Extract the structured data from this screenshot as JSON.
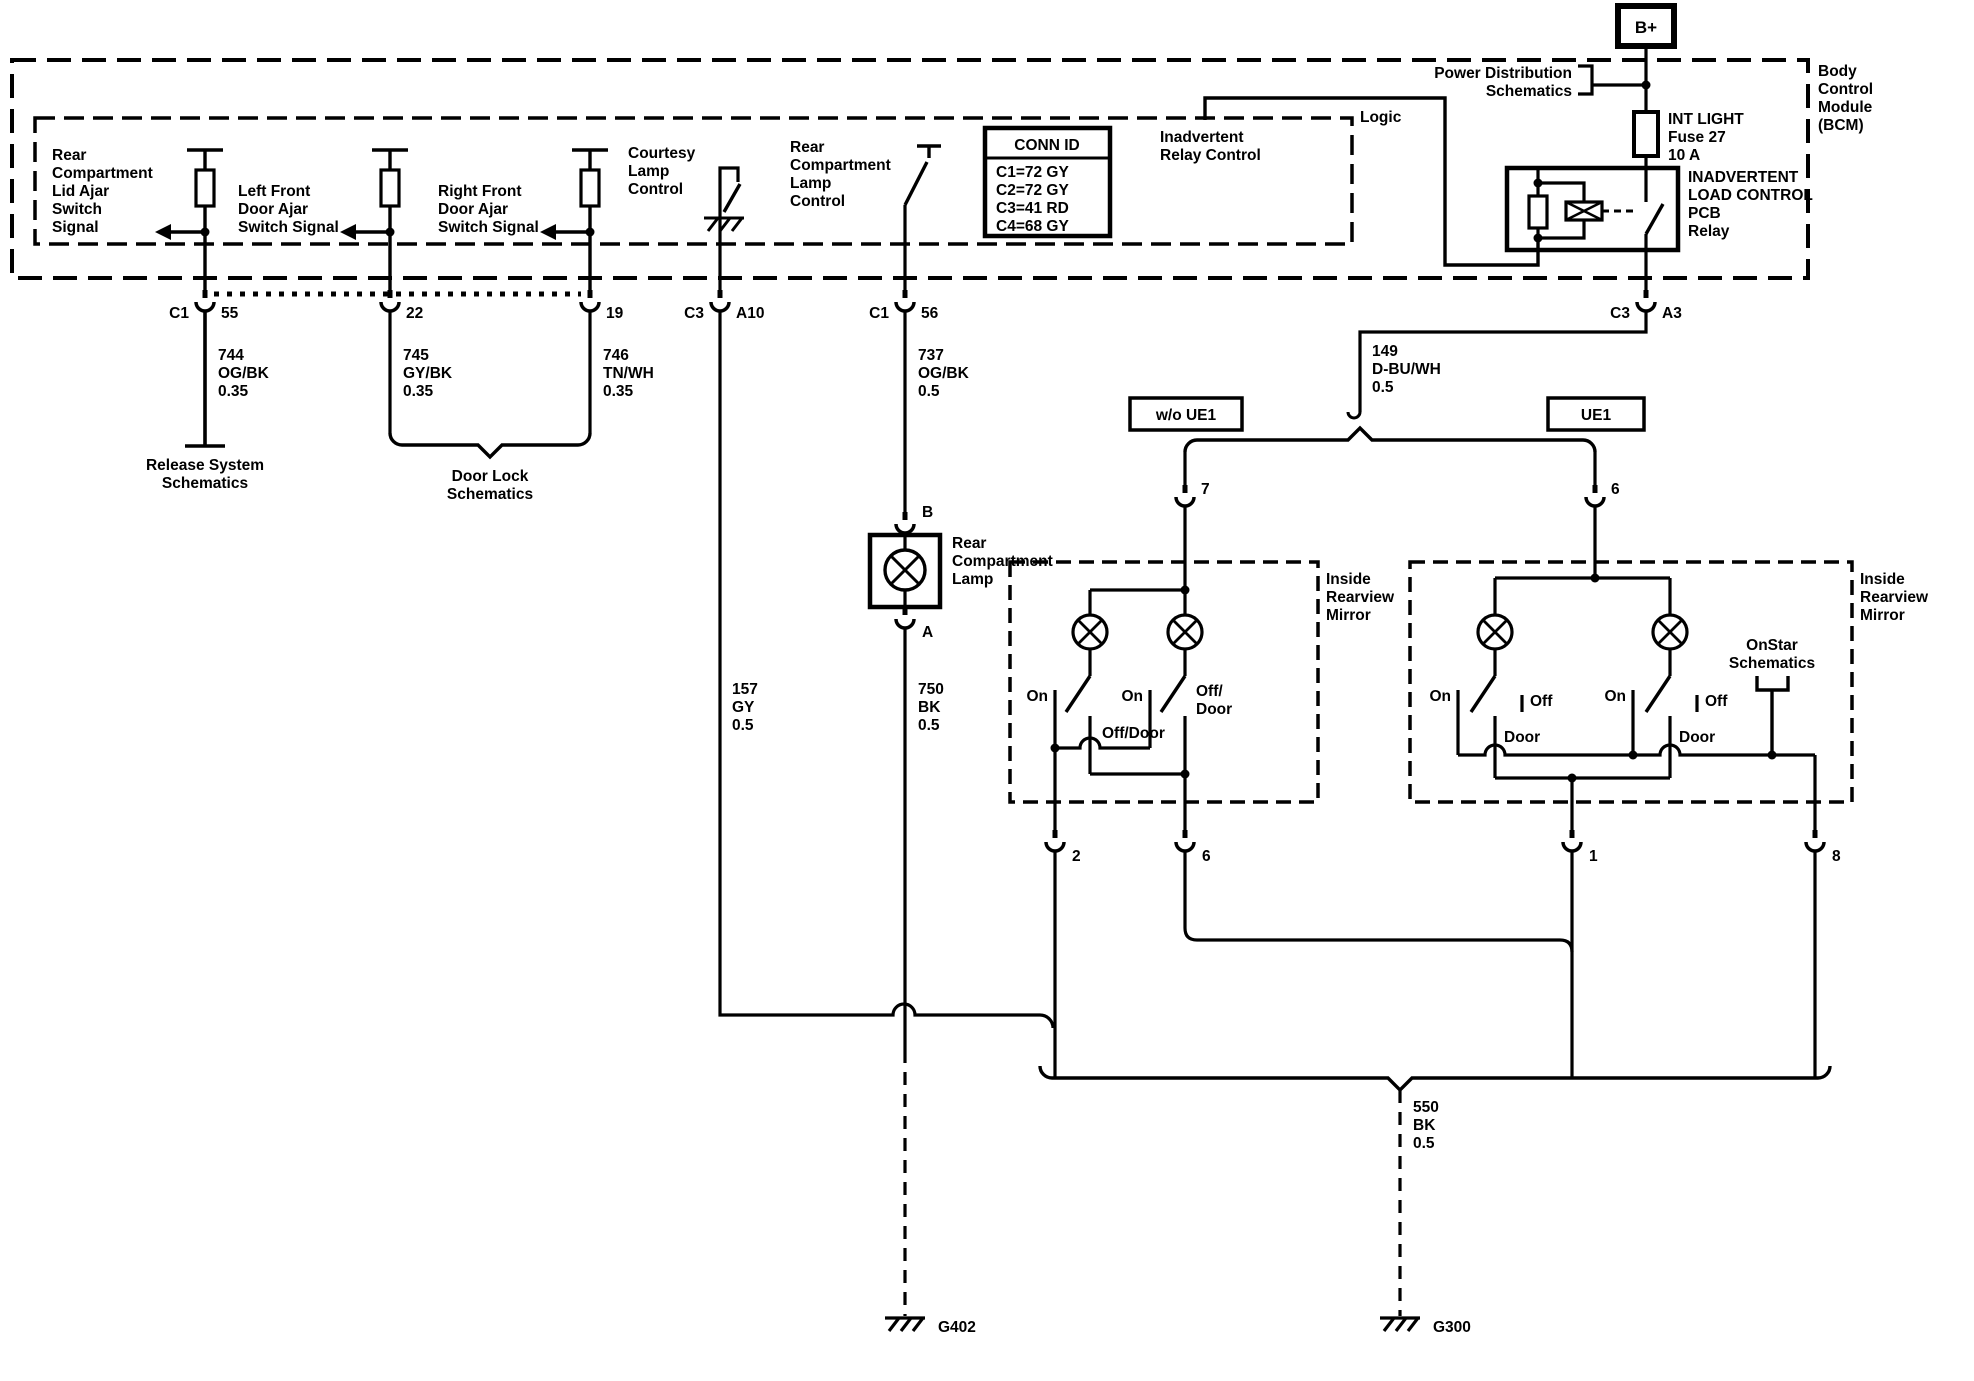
{
  "b_plus": "B+",
  "power_distribution": [
    "Power Distribution",
    "Schematics"
  ],
  "fuse": [
    "INT LIGHT",
    "Fuse 27",
    "10 A"
  ],
  "relay_name": [
    "INADVERTENT",
    "LOAD CONTROL",
    "PCB",
    "Relay"
  ],
  "bcm": [
    "Body",
    "Control",
    "Module",
    "(BCM)"
  ],
  "logic": "Logic",
  "inadvertent_relay_control": [
    "Inadvertent",
    "Relay Control"
  ],
  "conn_id": {
    "header": "CONN ID",
    "rows": [
      "C1=72 GY",
      "C2=72 GY",
      "C3=41 RD",
      "C4=68 GY"
    ]
  },
  "lid_ajar": [
    "Rear",
    "Compartment",
    "Lid Ajar",
    "Switch",
    "Signal"
  ],
  "lf_door": [
    "Left Front",
    "Door Ajar",
    "Switch Signal"
  ],
  "rf_door": [
    "Right Front",
    "Door Ajar",
    "Switch Signal"
  ],
  "courtesy": [
    "Courtesy",
    "Lamp",
    "Control"
  ],
  "rear_lamp_control": [
    "Rear",
    "Compartment",
    "Lamp",
    "Control"
  ],
  "pins": {
    "c1_a": "C1",
    "p55": "55",
    "p22": "22",
    "p19": "19",
    "c3_a": "C3",
    "pA10": "A10",
    "c1_b": "C1",
    "p56": "56",
    "c3_b": "C3",
    "pA3": "A3",
    "pB": "B",
    "pA": "A",
    "p7": "7",
    "p6_entry": "6",
    "p2": "2",
    "p6": "6",
    "p1": "1",
    "p8": "8"
  },
  "wires": {
    "w744": [
      "744",
      "OG/BK",
      "0.35"
    ],
    "w745": [
      "745",
      "GY/BK",
      "0.35"
    ],
    "w746": [
      "746",
      "TN/WH",
      "0.35"
    ],
    "w737": [
      "737",
      "OG/BK",
      "0.5"
    ],
    "w149": [
      "149",
      "D-BU/WH",
      "0.5"
    ],
    "w157": [
      "157",
      "GY",
      "0.5"
    ],
    "w750": [
      "750",
      "BK",
      "0.5"
    ],
    "w550": [
      "550",
      "BK",
      "0.5"
    ]
  },
  "release_system": [
    "Release System",
    "Schematics"
  ],
  "door_lock": [
    "Door Lock",
    "Schematics"
  ],
  "onstar": [
    "OnStar",
    "Schematics"
  ],
  "wo_ue1": "w/o UE1",
  "ue1": "UE1",
  "rear_lamp": [
    "Rear",
    "Compartment",
    "Lamp"
  ],
  "mirror_label": [
    "Inside",
    "Rearview",
    "Mirror"
  ],
  "mirror_left": {
    "on1": "On",
    "off_door1": "Off/Door",
    "on2": "On",
    "off_door2": [
      "Off/",
      "Door"
    ]
  },
  "mirror_right": {
    "on1": "On",
    "off1": "Off",
    "door1": "Door",
    "on2": "On",
    "off2": "Off",
    "door2": "Door"
  },
  "grounds": {
    "g402": "G402",
    "g300": "G300"
  },
  "colors": {
    "line": "#000000",
    "background": "#ffffff"
  }
}
